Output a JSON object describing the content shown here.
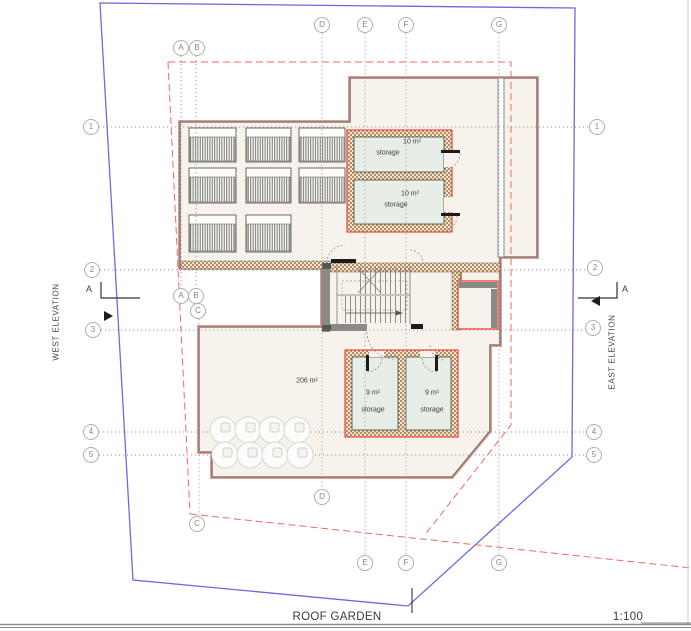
{
  "title_block": {
    "drawing_title": "ROOF GARDEN",
    "scale": "1:100"
  },
  "elevation_markers": {
    "west_label": "WEST ELEVATION",
    "east_label": "EAST ELEVATION",
    "west_section_letter": "A",
    "east_section_letter": "A"
  },
  "grid": {
    "bubbles": [
      "A",
      "B",
      "D",
      "E",
      "F",
      "G",
      "1",
      "2",
      "3",
      "4",
      "5",
      "A",
      "B",
      "C",
      "1",
      "2",
      "3",
      "4",
      "5",
      "C",
      "D",
      "E",
      "F",
      "G"
    ]
  },
  "rooms": {
    "storage_upper_1": {
      "area": "10 m²",
      "name": "storage"
    },
    "storage_upper_2": {
      "area": "10 m²",
      "name": "storage"
    },
    "storage_lower_1": {
      "area": "9 m²",
      "name": "storage"
    },
    "storage_lower_2": {
      "area": "9 m²",
      "name": "storage"
    },
    "roof_terrace": {
      "area": "206 m²"
    }
  },
  "colors": {
    "site_boundary_blue": "#6b6bdc",
    "building_outline_red": "#e8463f",
    "setback_dashed_red": "#ef6a60",
    "wall_gray": "#7d7d77",
    "wall_hatch_brown": "#b58c60",
    "storage_room_green": "#e7eee8",
    "floor_cream": "#f7f3ec"
  }
}
